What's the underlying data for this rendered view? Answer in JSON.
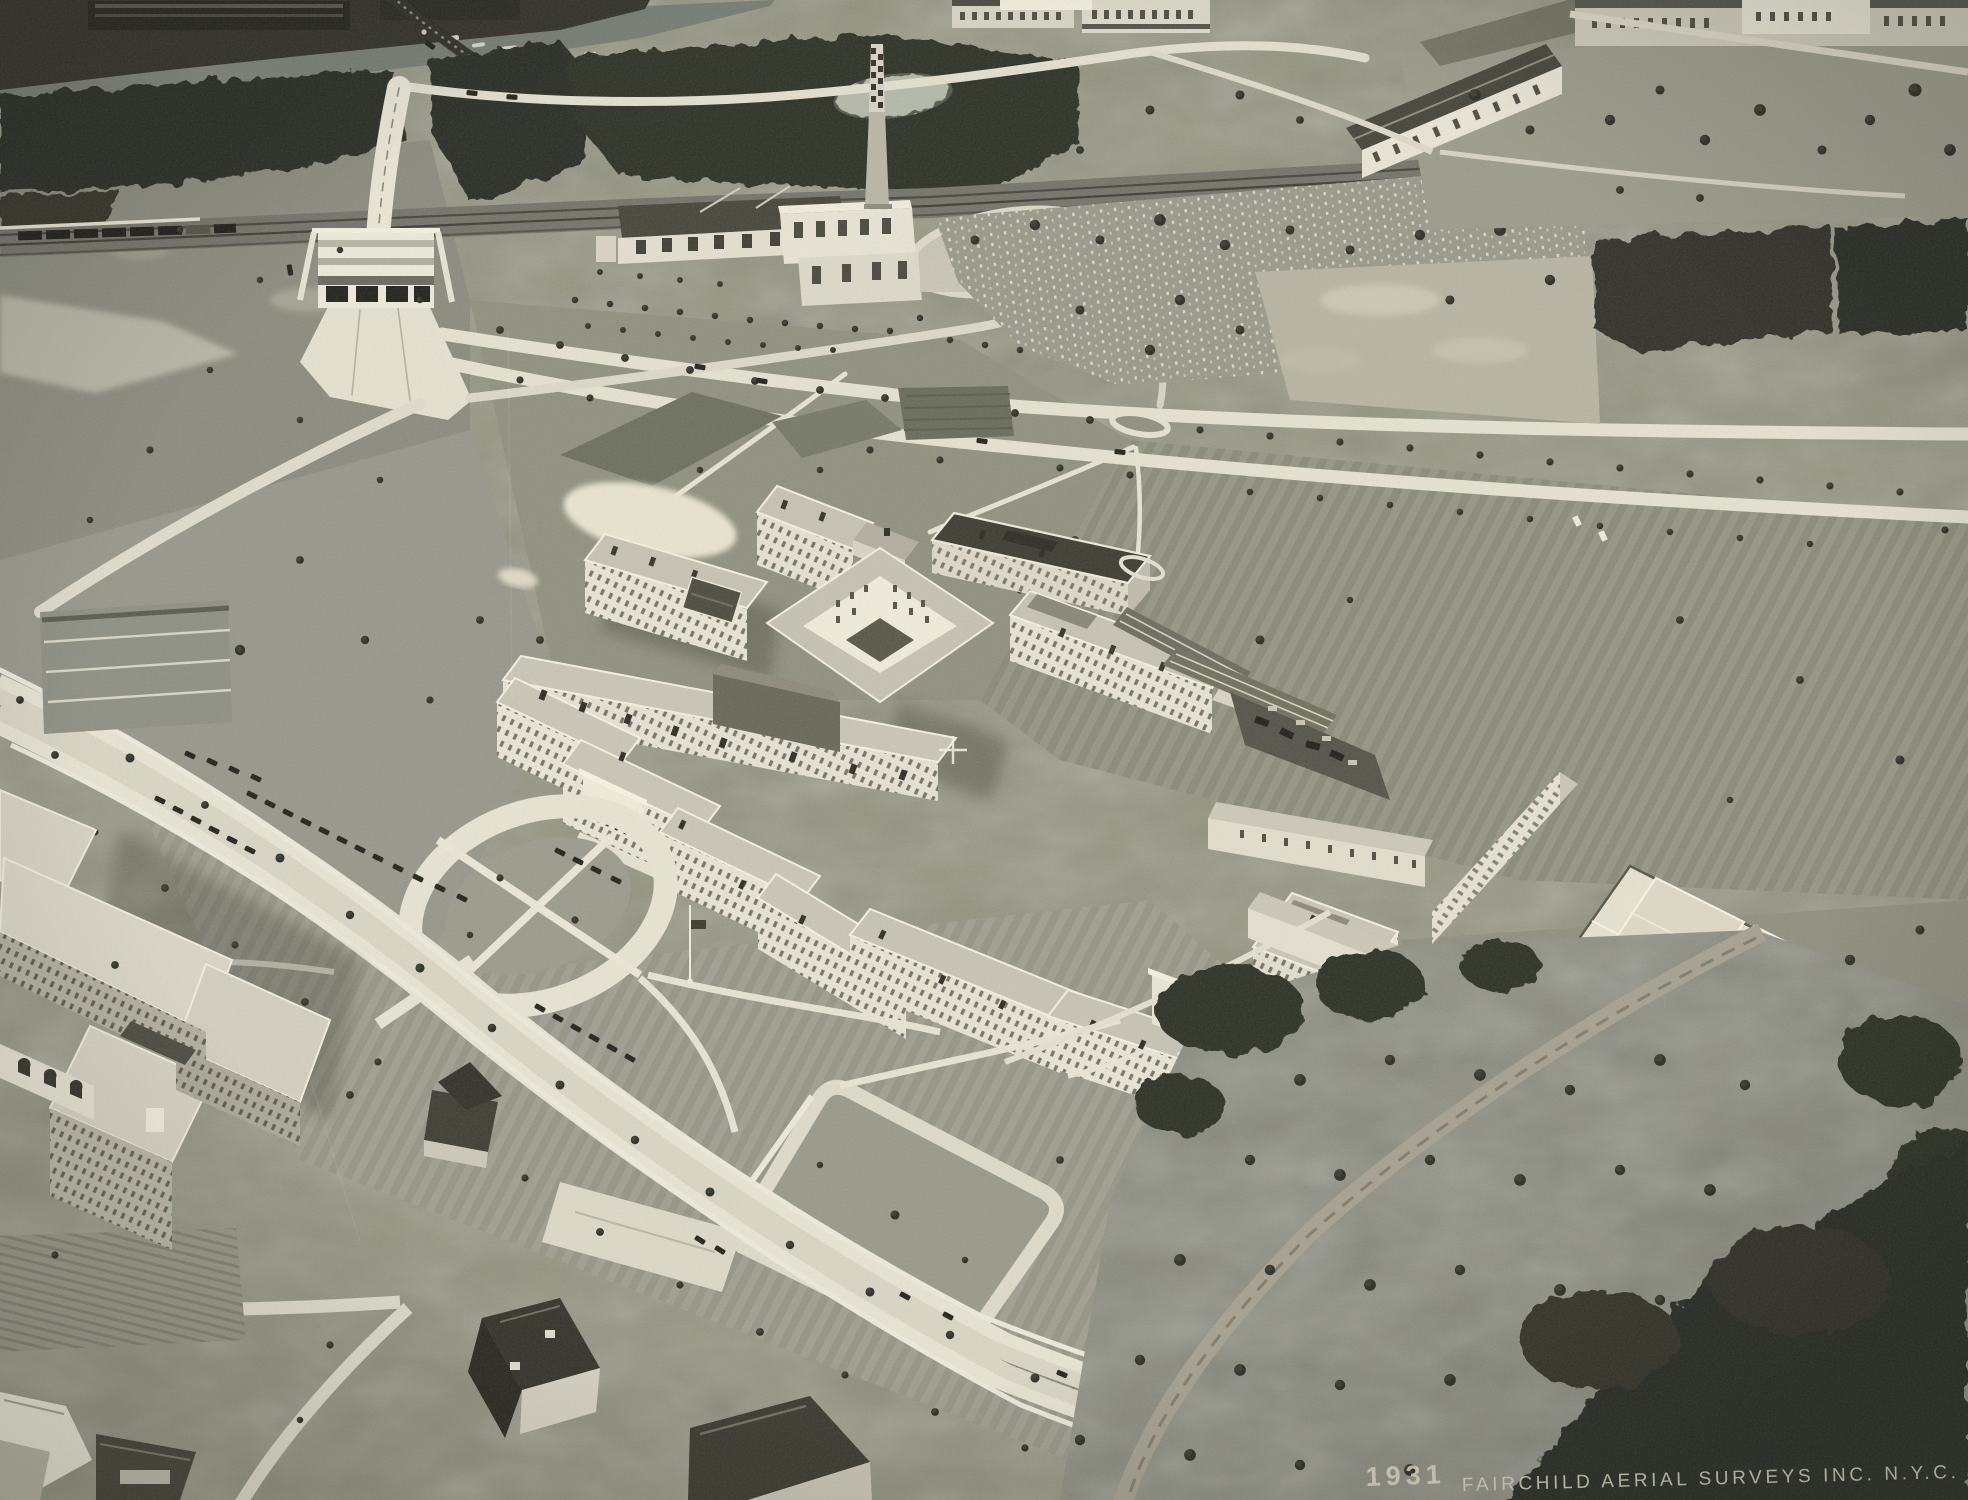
{
  "caption": {
    "year": "1931",
    "credit": "FAIRCHILD AERIAL SURVEYS INC. N.Y.C."
  },
  "photo": {
    "kind": "black-and-white oblique aerial photograph",
    "subject": "large cross-plan hospital campus with entrance drive circle, flagpole, tennis courts, greenhouses, power plant with smokestack, river with truss bridge and docks, railroad with freight train, viaduct overpass, cemetery, tree-lined boulevards, houses and orchard fields"
  },
  "scene": {
    "regions": [
      "river",
      "docks",
      "truss-bridge",
      "shore-trees",
      "railroad",
      "freight-train",
      "viaduct-overpass",
      "power-plant",
      "smokestack",
      "garage-buildings",
      "pond",
      "oval-loop-field",
      "cemetery",
      "bare-field",
      "upper-boulevard",
      "lower-boulevard",
      "campus-gate",
      "hospital-main-complex",
      "courtyard-lightwell",
      "entrance-portico",
      "entrance-drive-circle",
      "flagpole",
      "service-building",
      "greenhouses",
      "storage-yard",
      "recreation-building",
      "tennis-courts",
      "south-lawn-loop",
      "arch-pavilion",
      "nurses-residence",
      "garden-plots",
      "plowed-field",
      "houses",
      "orchard",
      "woods",
      "dirt-road",
      "parked-cars",
      "fiducial-cross-mark"
    ]
  }
}
